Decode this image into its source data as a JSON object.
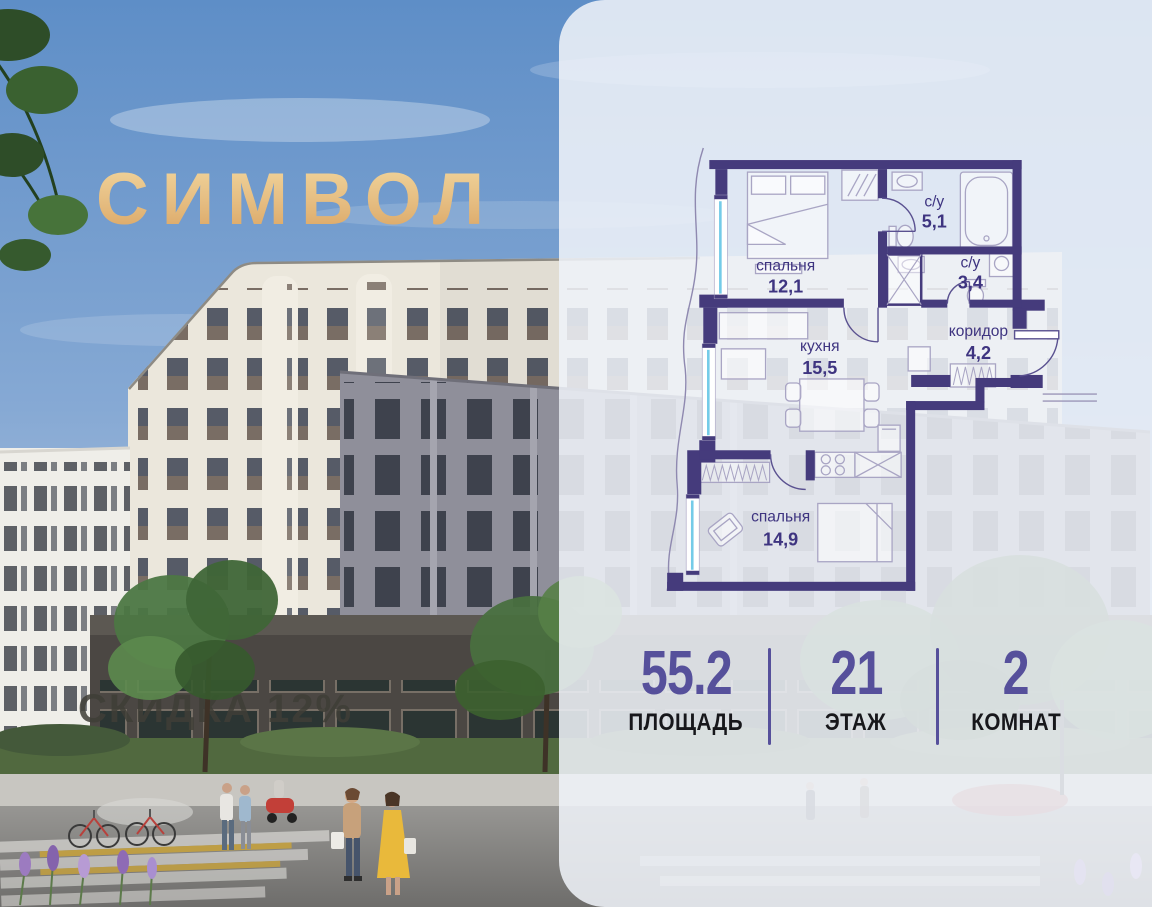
{
  "logo": {
    "text": "СИМВОЛ"
  },
  "photo": {
    "discount_watermark": "СКИДКА 12%"
  },
  "floor_plan": {
    "rooms": [
      {
        "name": "спальня",
        "area": "12,1"
      },
      {
        "name": "с/у",
        "area": "5,1"
      },
      {
        "name": "с/у",
        "area": "3,4"
      },
      {
        "name": "кухня",
        "area": "15,5"
      },
      {
        "name": "коридор",
        "area": "4,2"
      },
      {
        "name": "спальня",
        "area": "14,9"
      }
    ]
  },
  "stats": [
    {
      "value": "55.2",
      "label": "ПЛОЩАДЬ"
    },
    {
      "value": "21",
      "label": "ЭТАЖ"
    },
    {
      "value": "2",
      "label": "КОМНАТ"
    }
  ],
  "colors": {
    "wall_purple": "#453B7C",
    "plan_text": "#3E3480",
    "stat_number": "#56509B",
    "stat_label": "#17171B",
    "logo_gold_light": "#F2D79F",
    "logo_gold_dark": "#D9A260",
    "panel_background": "#EFF2F8",
    "window_glass": "#74CBE8"
  }
}
